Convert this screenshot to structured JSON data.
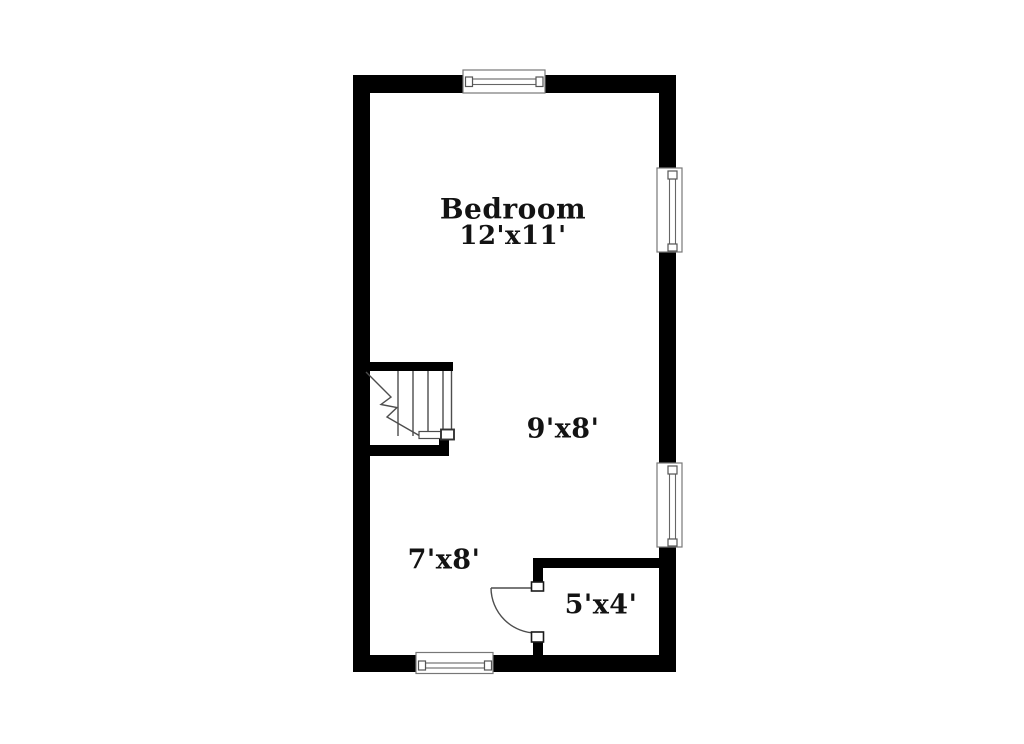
{
  "floor_plan": {
    "rooms": [
      {
        "id": "bedroom",
        "label": "Bedroom",
        "dimensions": "12'x11'"
      },
      {
        "id": "area-9x8",
        "label": "",
        "dimensions": "9'x8'"
      },
      {
        "id": "area-7x8",
        "label": "",
        "dimensions": "7'x8'"
      },
      {
        "id": "closet-5x4",
        "label": "",
        "dimensions": "5'x4'"
      }
    ],
    "features": {
      "windows": 4,
      "doors": 1,
      "staircase": 1
    },
    "colors": {
      "wall": "#000000",
      "thin_line": "#4d4d4d",
      "text": "#131313",
      "background": "#ffffff"
    }
  }
}
